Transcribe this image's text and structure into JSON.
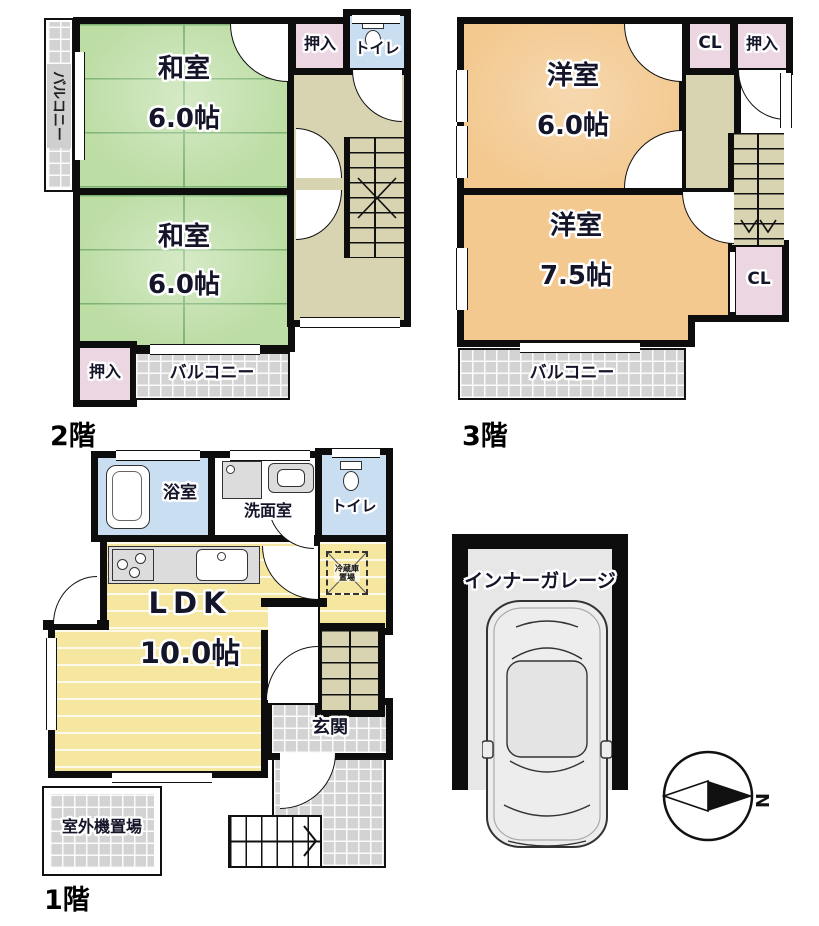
{
  "f2": {
    "label": "2階",
    "washitsu1": "和室",
    "washitsu1_size": "6.0帖",
    "washitsu2": "和室",
    "washitsu2_size": "6.0帖",
    "oshiire_top": "押入",
    "toilet": "トイレ",
    "oshiire_bottom": "押入",
    "balcony": "バルコニー",
    "balcony_side": "バルコニー"
  },
  "f3": {
    "label": "3階",
    "yoshitsu1": "洋室",
    "yoshitsu1_size": "6.0帖",
    "cl1": "CL",
    "oshiire": "押入",
    "yoshitsu2": "洋室",
    "yoshitsu2_size": "7.5帖",
    "cl2": "CL",
    "balcony": "バルコニー"
  },
  "f1": {
    "label": "1階",
    "bath": "浴室",
    "washroom": "洗面室",
    "toilet": "トイレ",
    "ldk": "LDK",
    "ldk_size": "10.0帖",
    "genkan": "玄関",
    "fridge": "冷蔵庫置場",
    "outdoor_unit": "室外機置場"
  },
  "garage": {
    "label": "インナーガレージ"
  },
  "compass": {
    "north": "N"
  },
  "colors": {
    "wall": "#0d0d0d",
    "tatami_green": "#bcdda4",
    "tatami_line": "#7cb271",
    "western_orange": "#f3c990",
    "closet_pink": "#ecd6e1",
    "water_blue": "#c9def0",
    "hall_tan": "#d8d3b1",
    "ldk_yellow": "#f6e7a0",
    "tile_gray": "#d3d3d3",
    "garage_gray": "#e7e7e7"
  }
}
